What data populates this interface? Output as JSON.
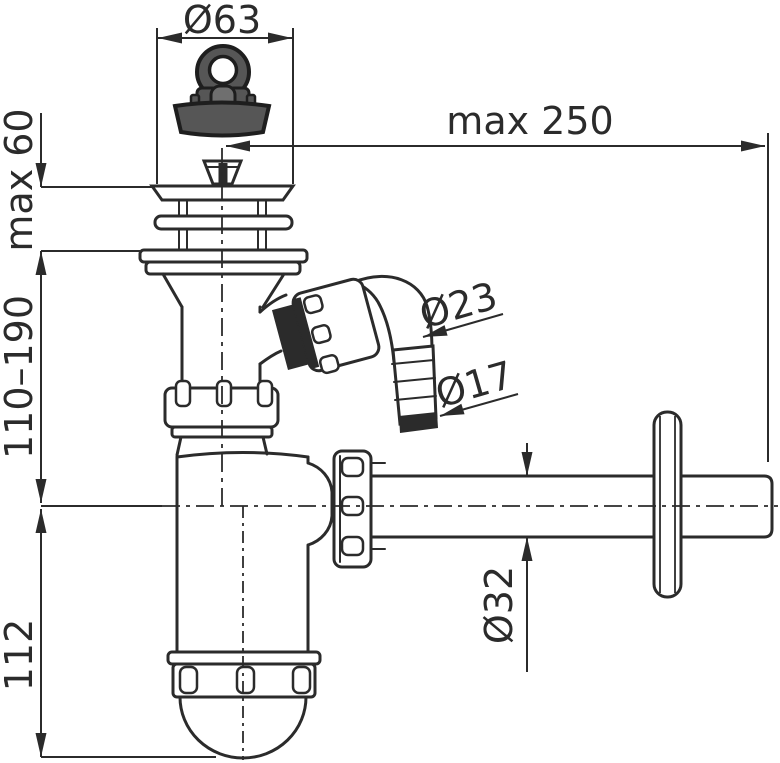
{
  "drawing": {
    "background": "#ffffff",
    "ink": "#2b2b2b",
    "plug_gray": "#565656",
    "labels": {
      "plug_diameter": "Ø63",
      "wall_distance": "max 250",
      "deck_thickness": "max 60",
      "height_range": "110–190",
      "cup_height": "112",
      "elbow_diameter": "Ø23",
      "barb_diameter": "Ø17",
      "pipe_diameter": "Ø32"
    }
  }
}
